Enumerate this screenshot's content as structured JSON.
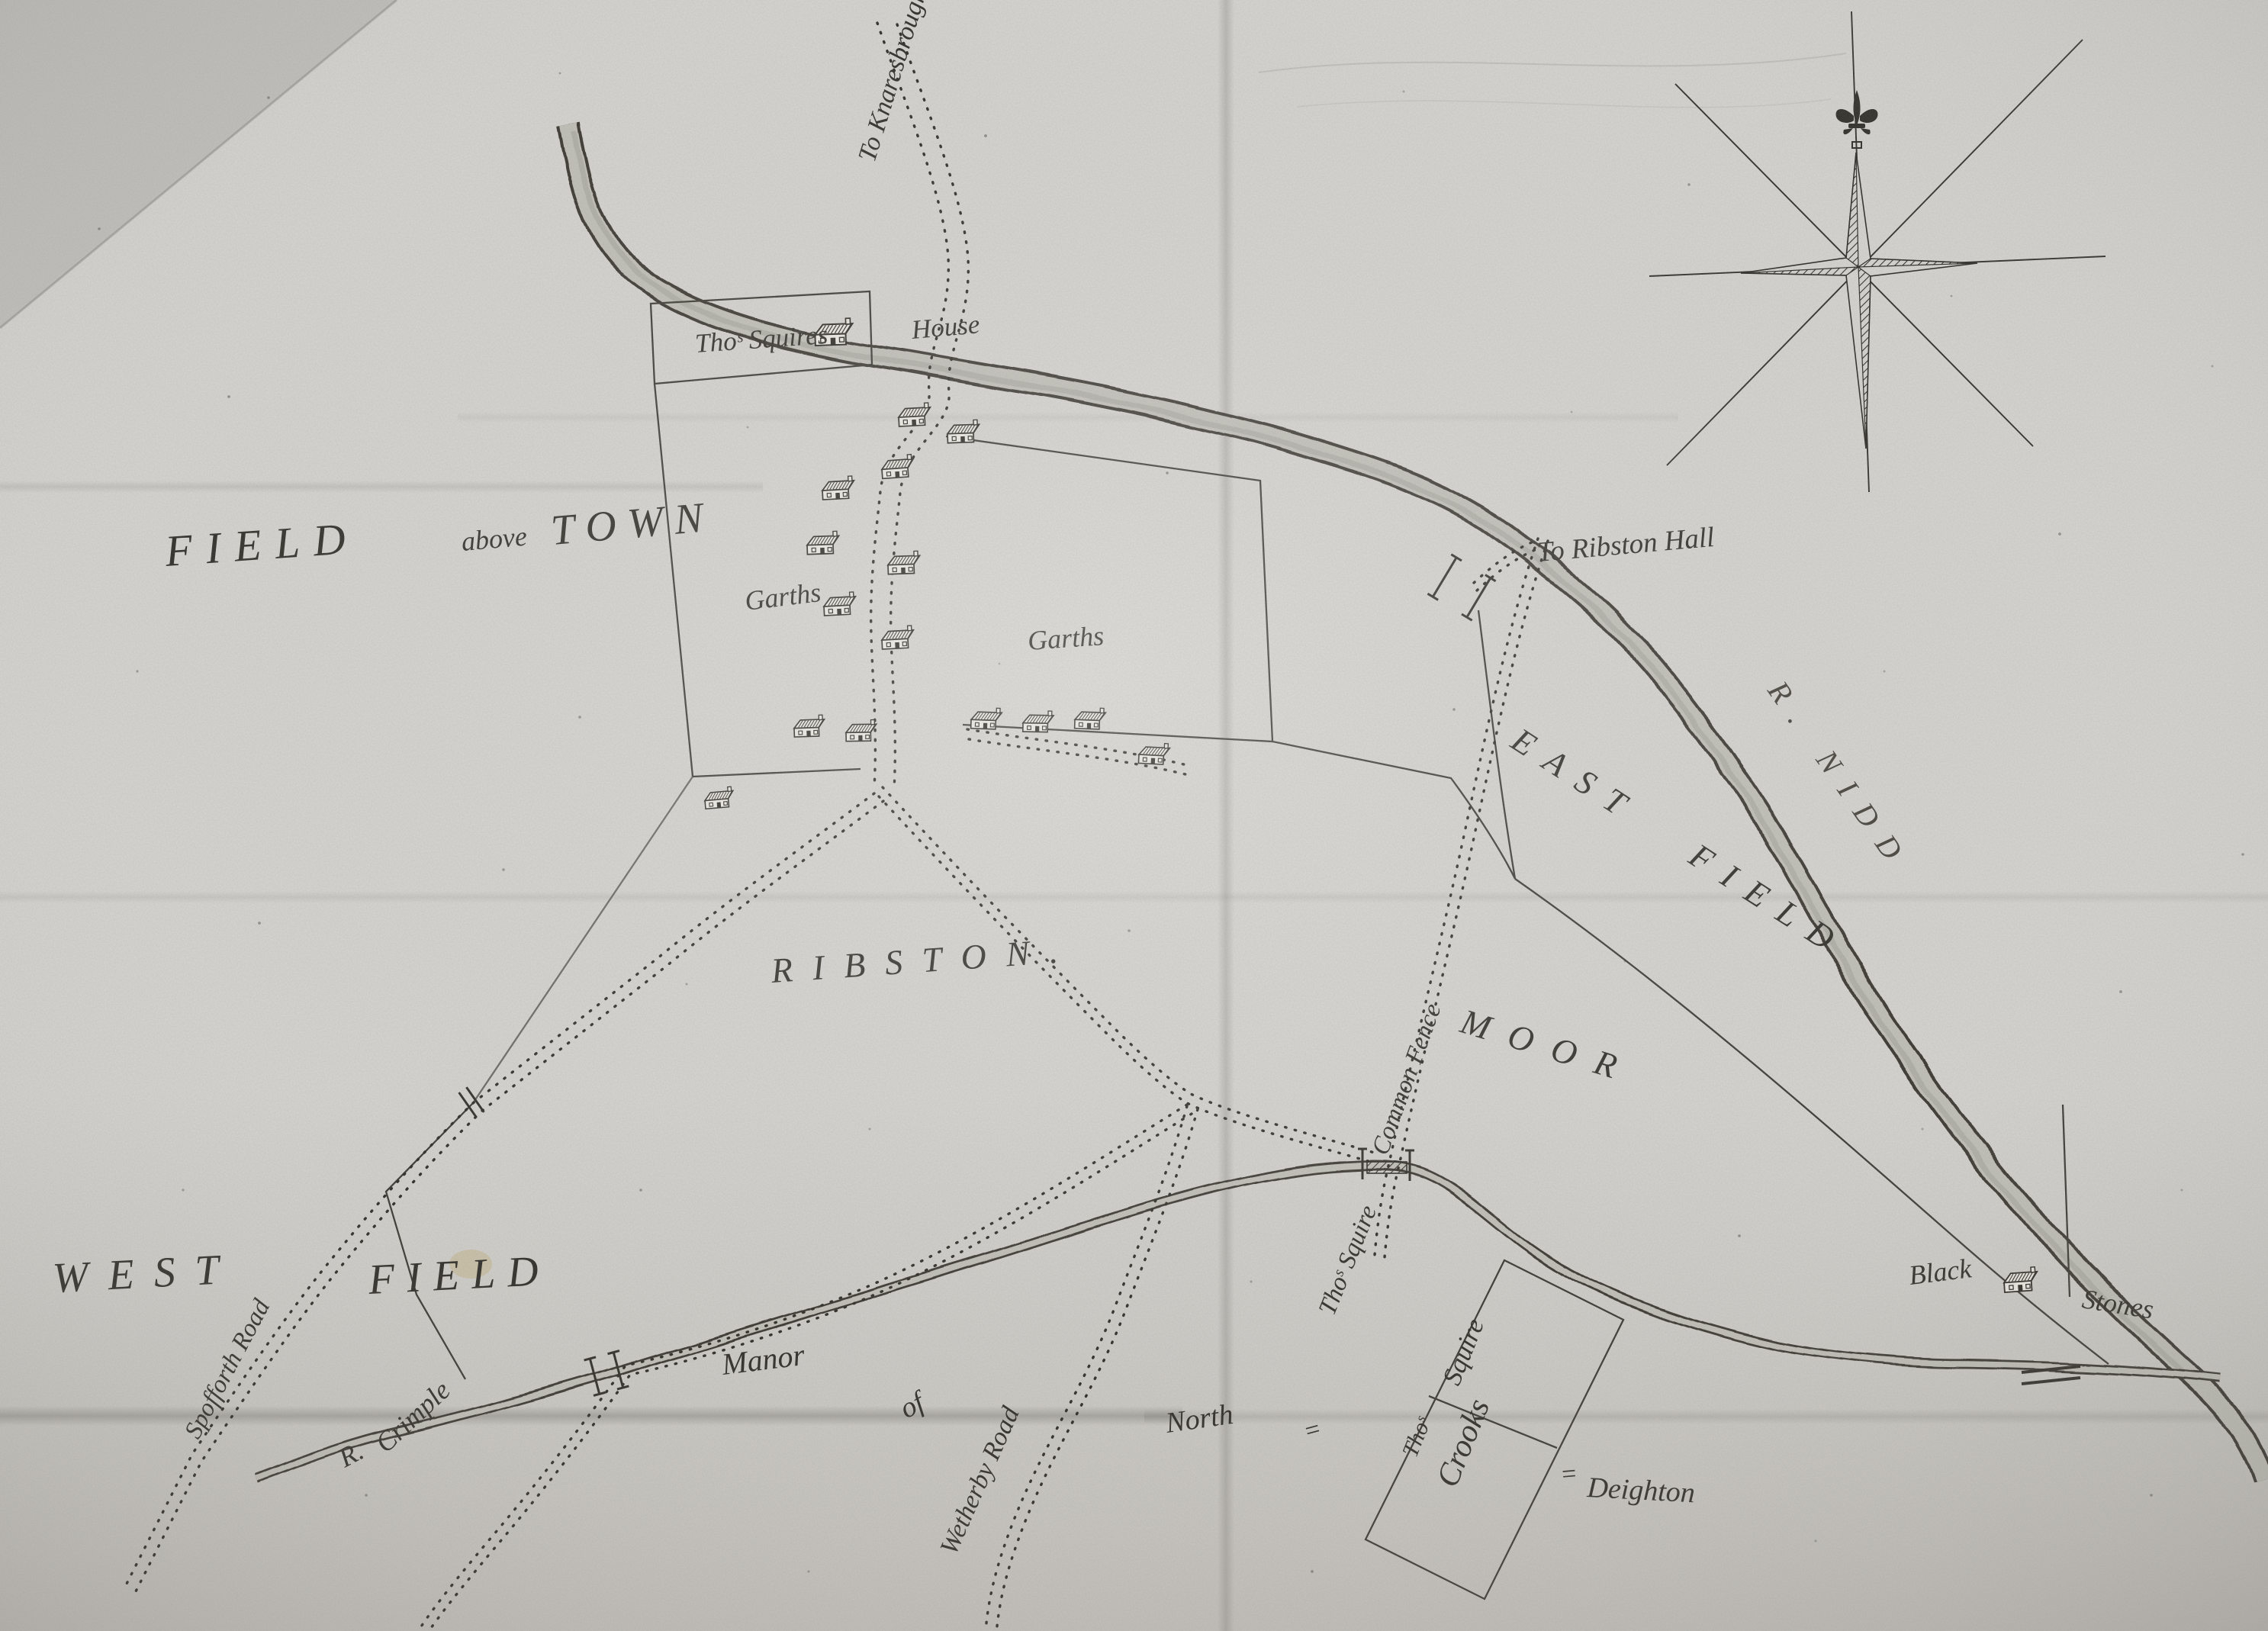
{
  "map": {
    "title": "Manuscript estate map of Ribston township",
    "labels": {
      "fields": {
        "field_word": "FIELD",
        "above_word": "above",
        "town_word": "TOWN",
        "garths_west": "Garths",
        "garths_east": "Garths",
        "east_field": "EAST FIELD",
        "moor": "MOOR",
        "west_word": "WEST",
        "west_field_word": "FIELD",
        "ribston": "RIBSTON."
      },
      "roads": {
        "to_knaresbrough": "To Knaresbrough",
        "to_ribston_hall": "To Ribston Hall",
        "spofforth_road": "Spofforth Road",
        "wetherby_road": "Wetherby Road"
      },
      "rivers": {
        "nidd": "R. NIDD",
        "crimple_r": "R.",
        "crimple": "Crimple"
      },
      "properties": {
        "thos_squires": "Thoˢ Squires",
        "squires_house": "House",
        "thos_squire_fence": "Thoˢ Squire",
        "common_fence": "Common Fence",
        "crooks_thos": "Thoˢ",
        "crooks_squire": "Squire",
        "crooks_word": "Crooks"
      },
      "places": {
        "manor_word": "Manor",
        "of_word": "of",
        "north_word": "North",
        "hyphen_after_north": "=",
        "hyphen_before_deighton": "=",
        "deighton": "Deighton",
        "black_word": "Black",
        "stones_word": "Stones"
      }
    },
    "icons": {
      "compass_fleur": "fleur-de-lis",
      "compass_points": 8,
      "house_icon": "house",
      "bridge_icon": "bridge",
      "gate_icon": "gate"
    },
    "colors": {
      "paper": "#d7d6d2",
      "ink": "#312f29",
      "river_wash": "#c2c1ba",
      "stain": "#c0a86a"
    }
  }
}
